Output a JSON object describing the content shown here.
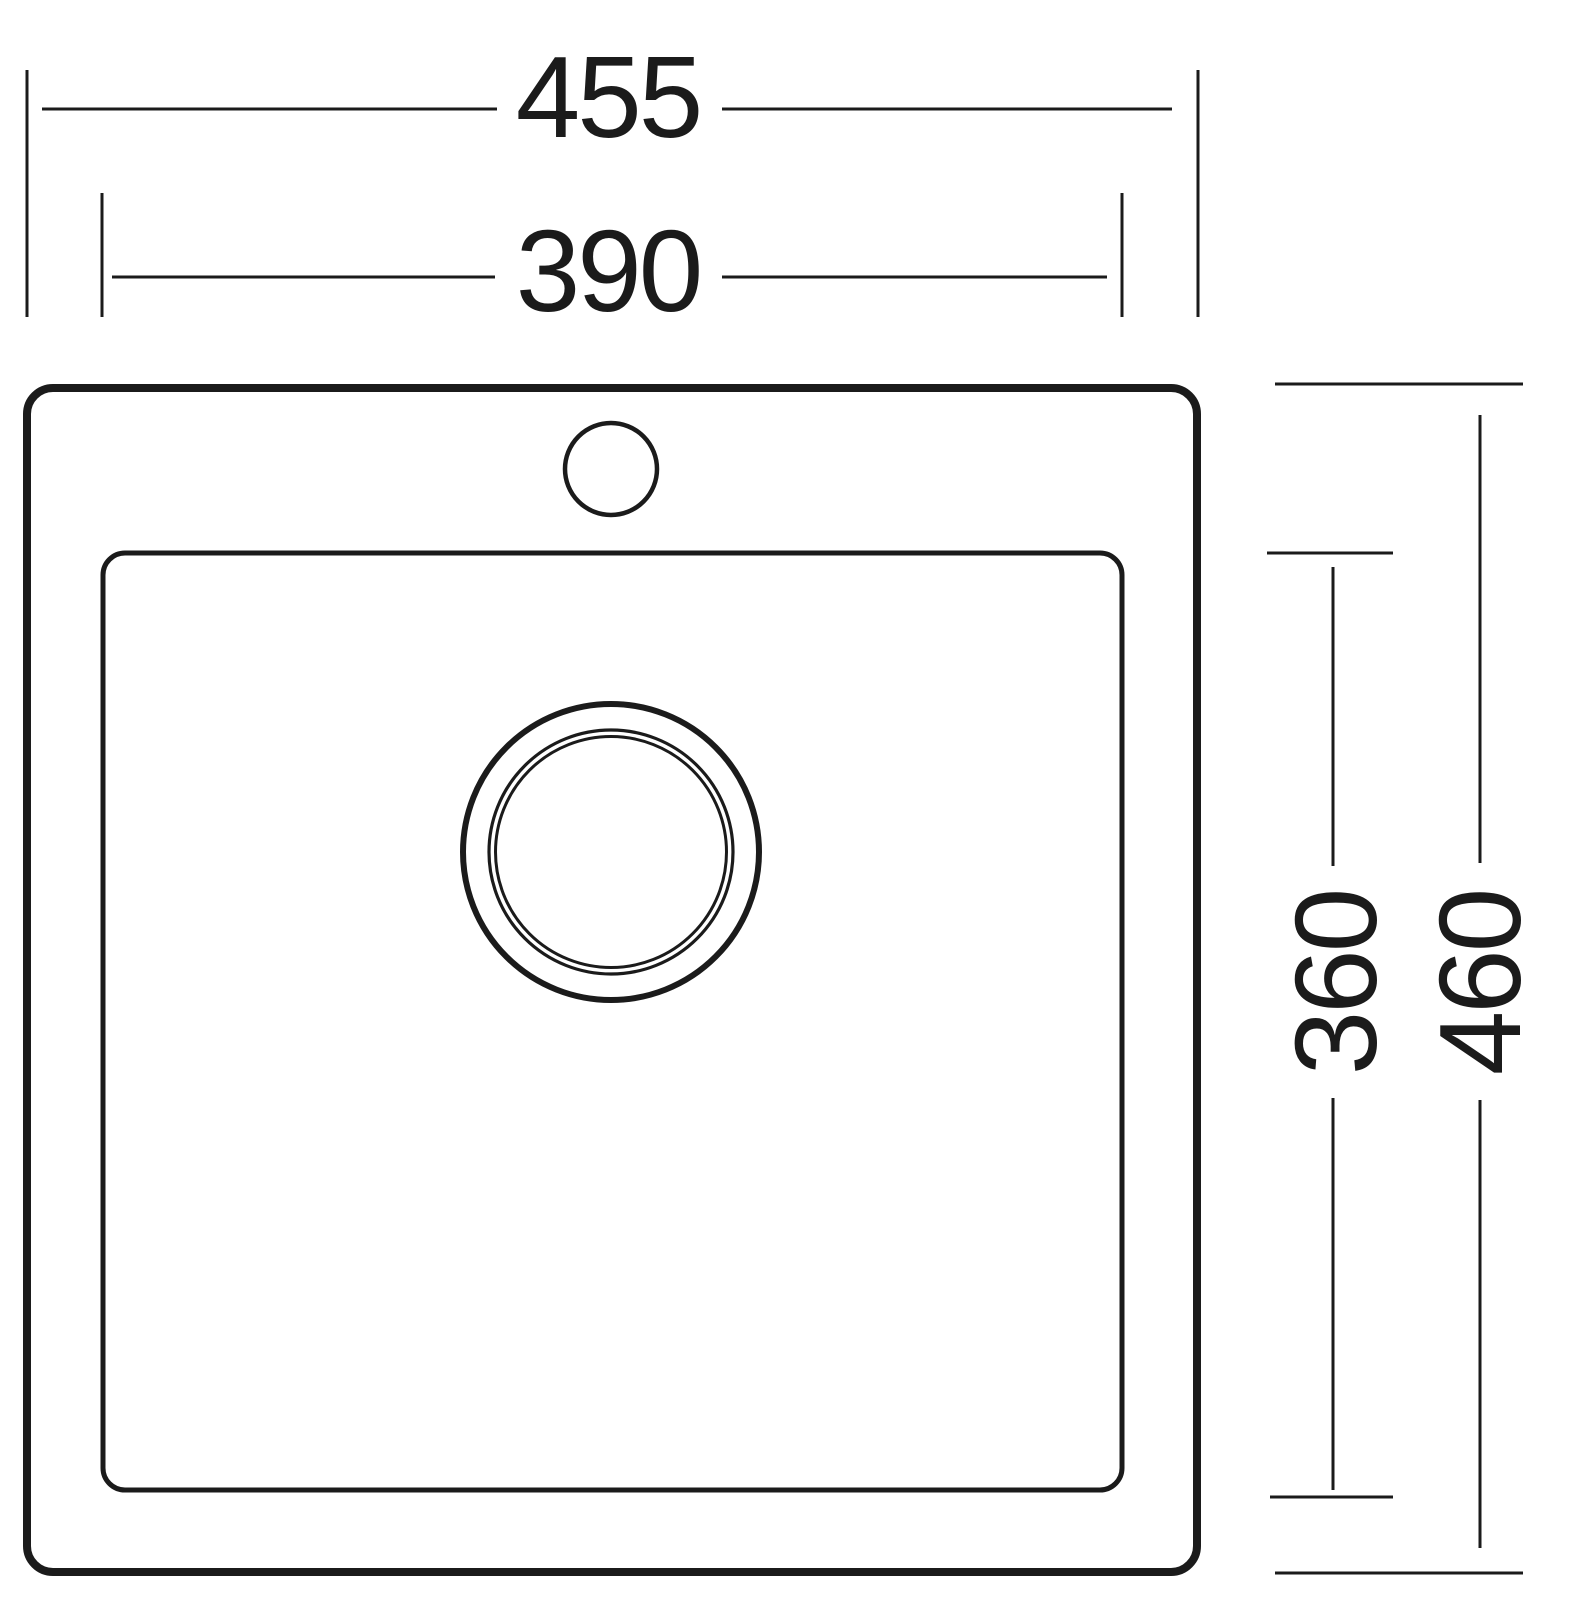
{
  "drawing": {
    "type": "technical-dimension-drawing",
    "subject": "kitchen sink top view",
    "colors": {
      "line": "#1b1b1b",
      "background": "#ffffff"
    },
    "dimensions": {
      "overall_width": "455",
      "basin_width": "390",
      "basin_depth": "360",
      "overall_depth": "460"
    }
  }
}
